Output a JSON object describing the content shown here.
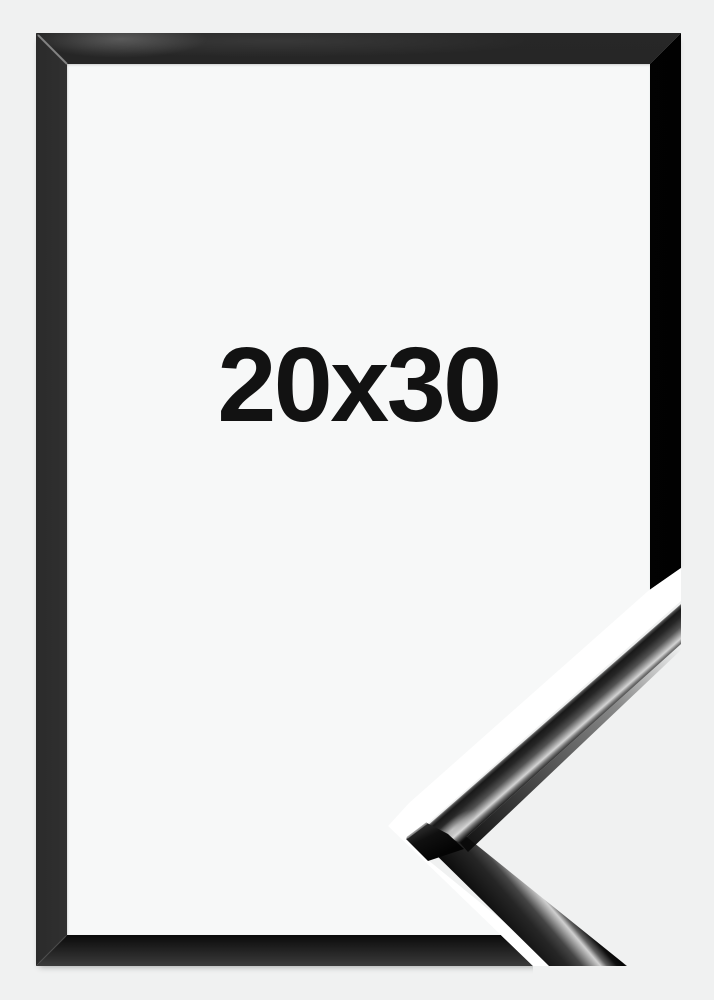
{
  "image_type": "product-photo",
  "label": {
    "size": "20x30"
  },
  "frame": {
    "color_name": "black"
  },
  "colors": {
    "page_bg": "#f0f1f1",
    "mat": "#f7f8f8",
    "separator_white": "#ffffff",
    "frame_black": "#0a0a0a",
    "text": "#121212"
  }
}
